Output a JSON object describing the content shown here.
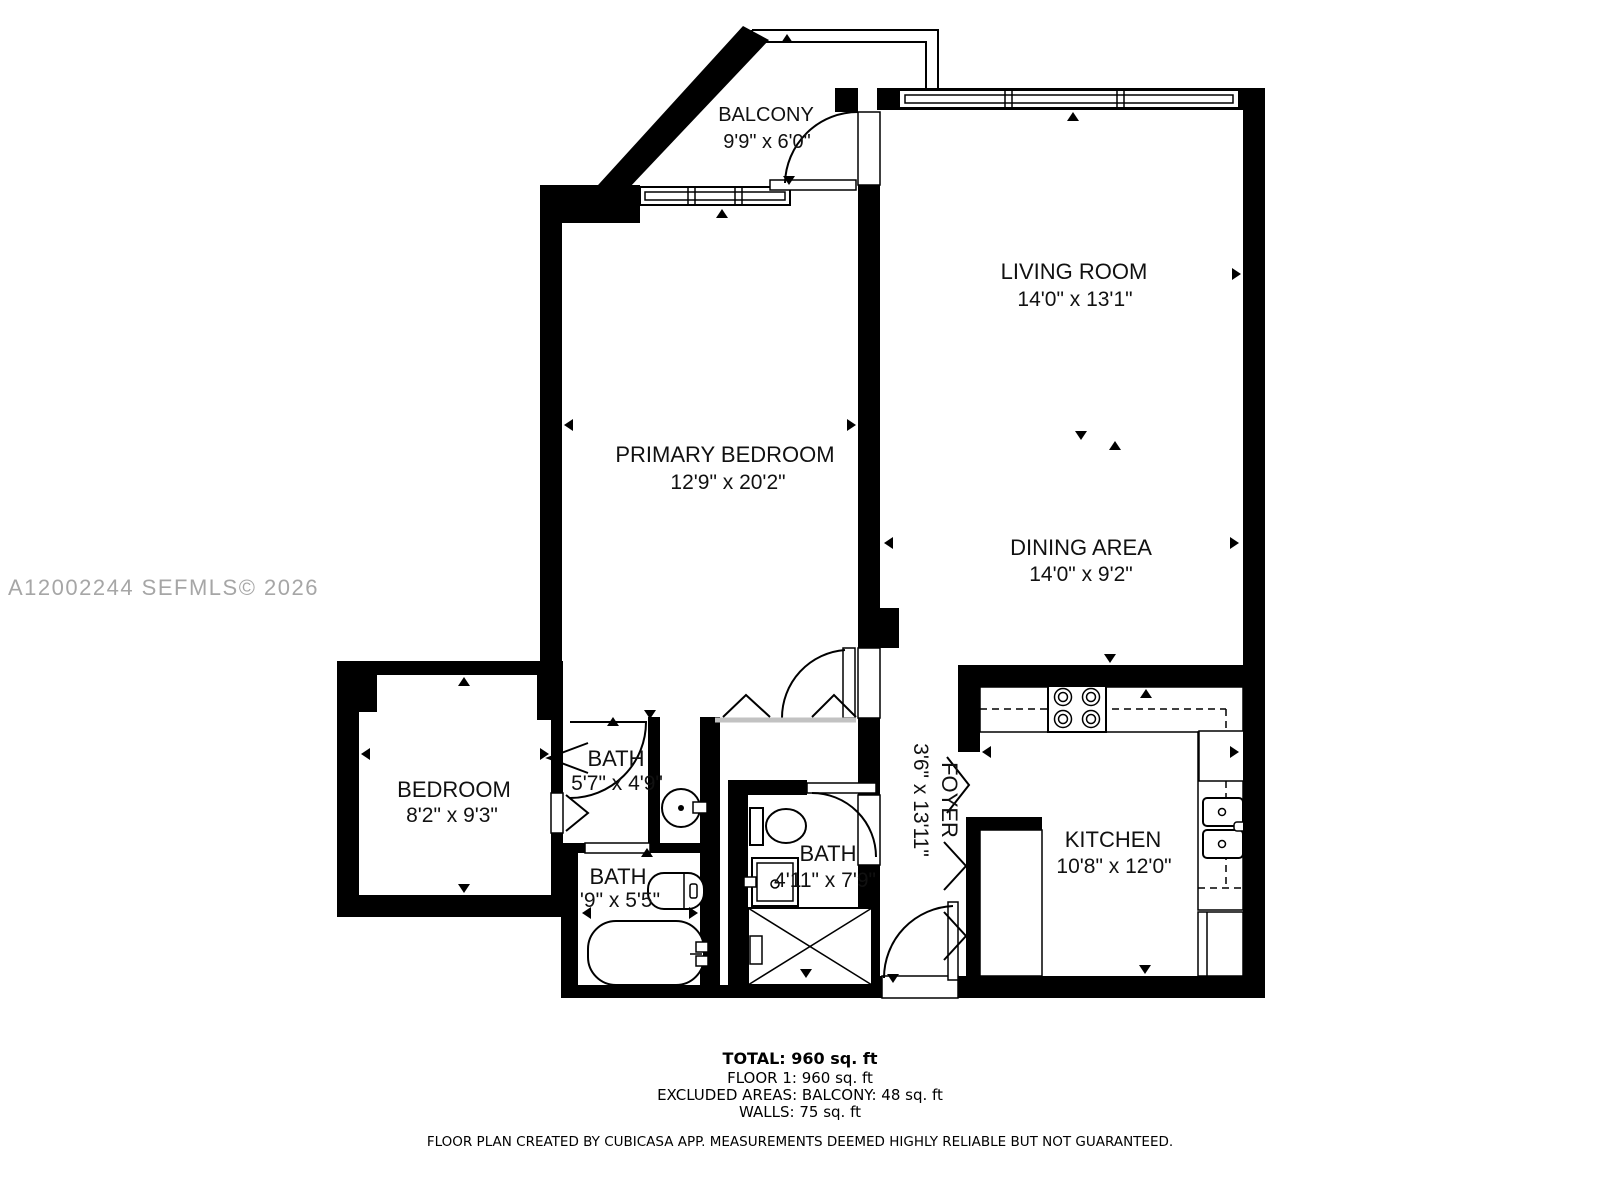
{
  "watermark": "A12002244  SEFMLS© 2026",
  "rooms": {
    "balcony": {
      "name": "BALCONY",
      "dims": "9'9\" x 6'0\""
    },
    "living_room": {
      "name": "LIVING ROOM",
      "dims": "14'0\" x 13'1\""
    },
    "primary_bedroom": {
      "name": "PRIMARY BEDROOM",
      "dims": "12'9\" x 20'2\""
    },
    "dining_area": {
      "name": "DINING AREA",
      "dims": "14'0\" x 9'2\""
    },
    "kitchen": {
      "name": "KITCHEN",
      "dims": "10'8\" x 12'0\""
    },
    "foyer": {
      "name": "FOYER",
      "dims": "3'6\" x 13'11\""
    },
    "bedroom": {
      "name": "BEDROOM",
      "dims": "8'2\" x 9'3\""
    },
    "bath_top": {
      "name": "BATH",
      "dims": "5'7\" x 4'9\""
    },
    "bath_bottom": {
      "name": "BATH",
      "dims": "'9\" x 5'5\""
    },
    "bath_middle": {
      "name": "BATH",
      "dims": "4'11\" x 7'9\""
    }
  },
  "summary": {
    "total": "TOTAL: 960 sq. ft",
    "floor1": "FLOOR 1: 960 sq. ft",
    "excluded": "EXCLUDED AREAS: BALCONY: 48 sq. ft",
    "walls": "WALLS: 75 sq. ft"
  },
  "disclaimer": "FLOOR PLAN CREATED BY CUBICASA APP. MEASUREMENTS DEEMED HIGHLY RELIABLE BUT NOT GUARANTEED."
}
